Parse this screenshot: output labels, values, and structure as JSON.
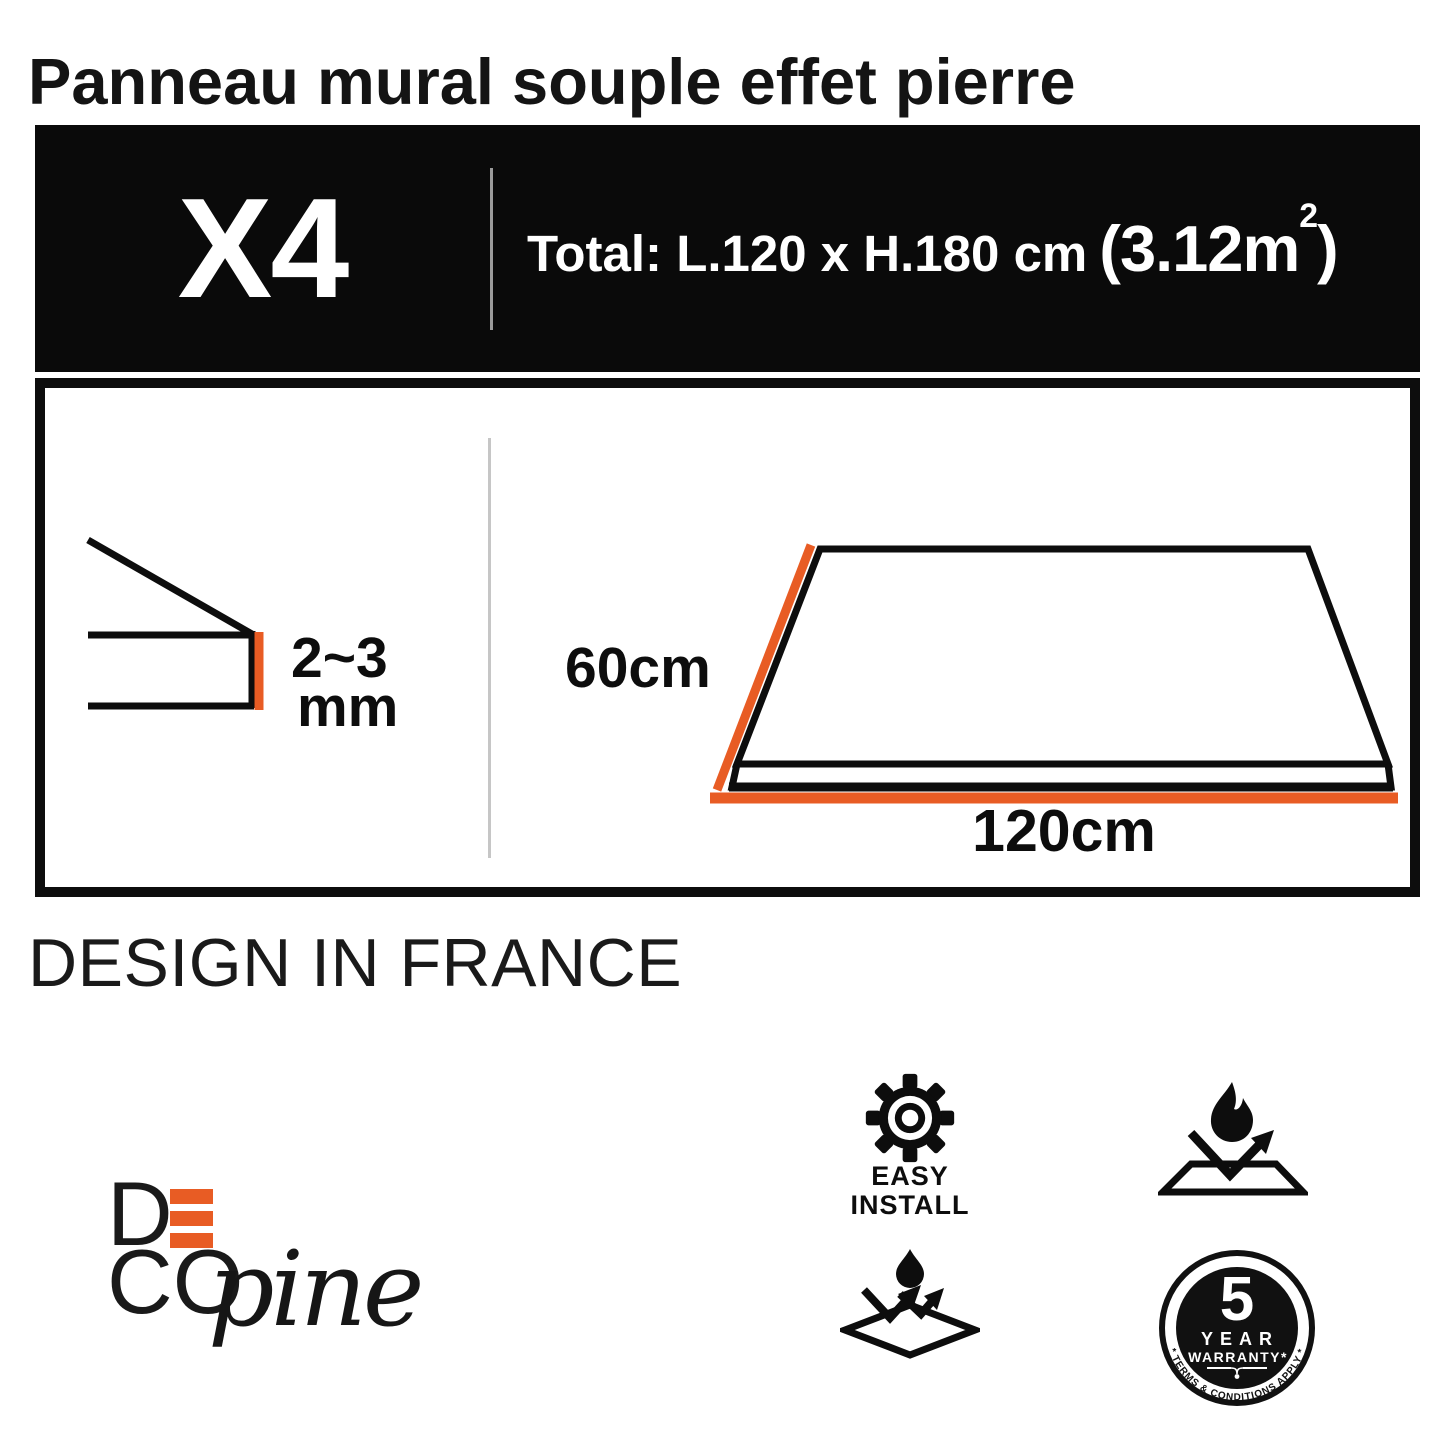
{
  "title": "Panneau mural souple effet pierre",
  "banner": {
    "quantity": "X4",
    "total_prefix": "Total: L.120 x H.180 cm",
    "area_open": "(",
    "area_value": "3.12m",
    "area_sup": "2",
    "area_close": ")"
  },
  "diagrams": {
    "thickness_value": "2~3",
    "thickness_unit": "mm",
    "height_label": "60cm",
    "width_label": "120cm"
  },
  "design_origin": "DESIGN IN FRANCE",
  "brand": {
    "d": "D",
    "co": "CO",
    "script": "pine"
  },
  "features": {
    "easy_install": {
      "line1": "EASY",
      "line2": "INSTALL"
    },
    "warranty": {
      "number": "5",
      "year": "YEAR",
      "warranty": "WARRANTY*",
      "terms": "* TERMS & CONDITIONS APPLY *"
    }
  },
  "icons": {
    "quantity_panel": "panel-thickness-diagram",
    "panel_size": "panel-size-diagram",
    "easy_install": "gear-icon",
    "fire": "fire-resistant-icon",
    "water": "water-resistant-icon",
    "warranty": "warranty-badge"
  },
  "colors": {
    "accent_orange": "#E85C24",
    "ink": "#0D0D0D",
    "banner_bg": "#0A0A0A",
    "banner_divider": "#9B9B9B",
    "box_divider": "#C6C6C6"
  }
}
